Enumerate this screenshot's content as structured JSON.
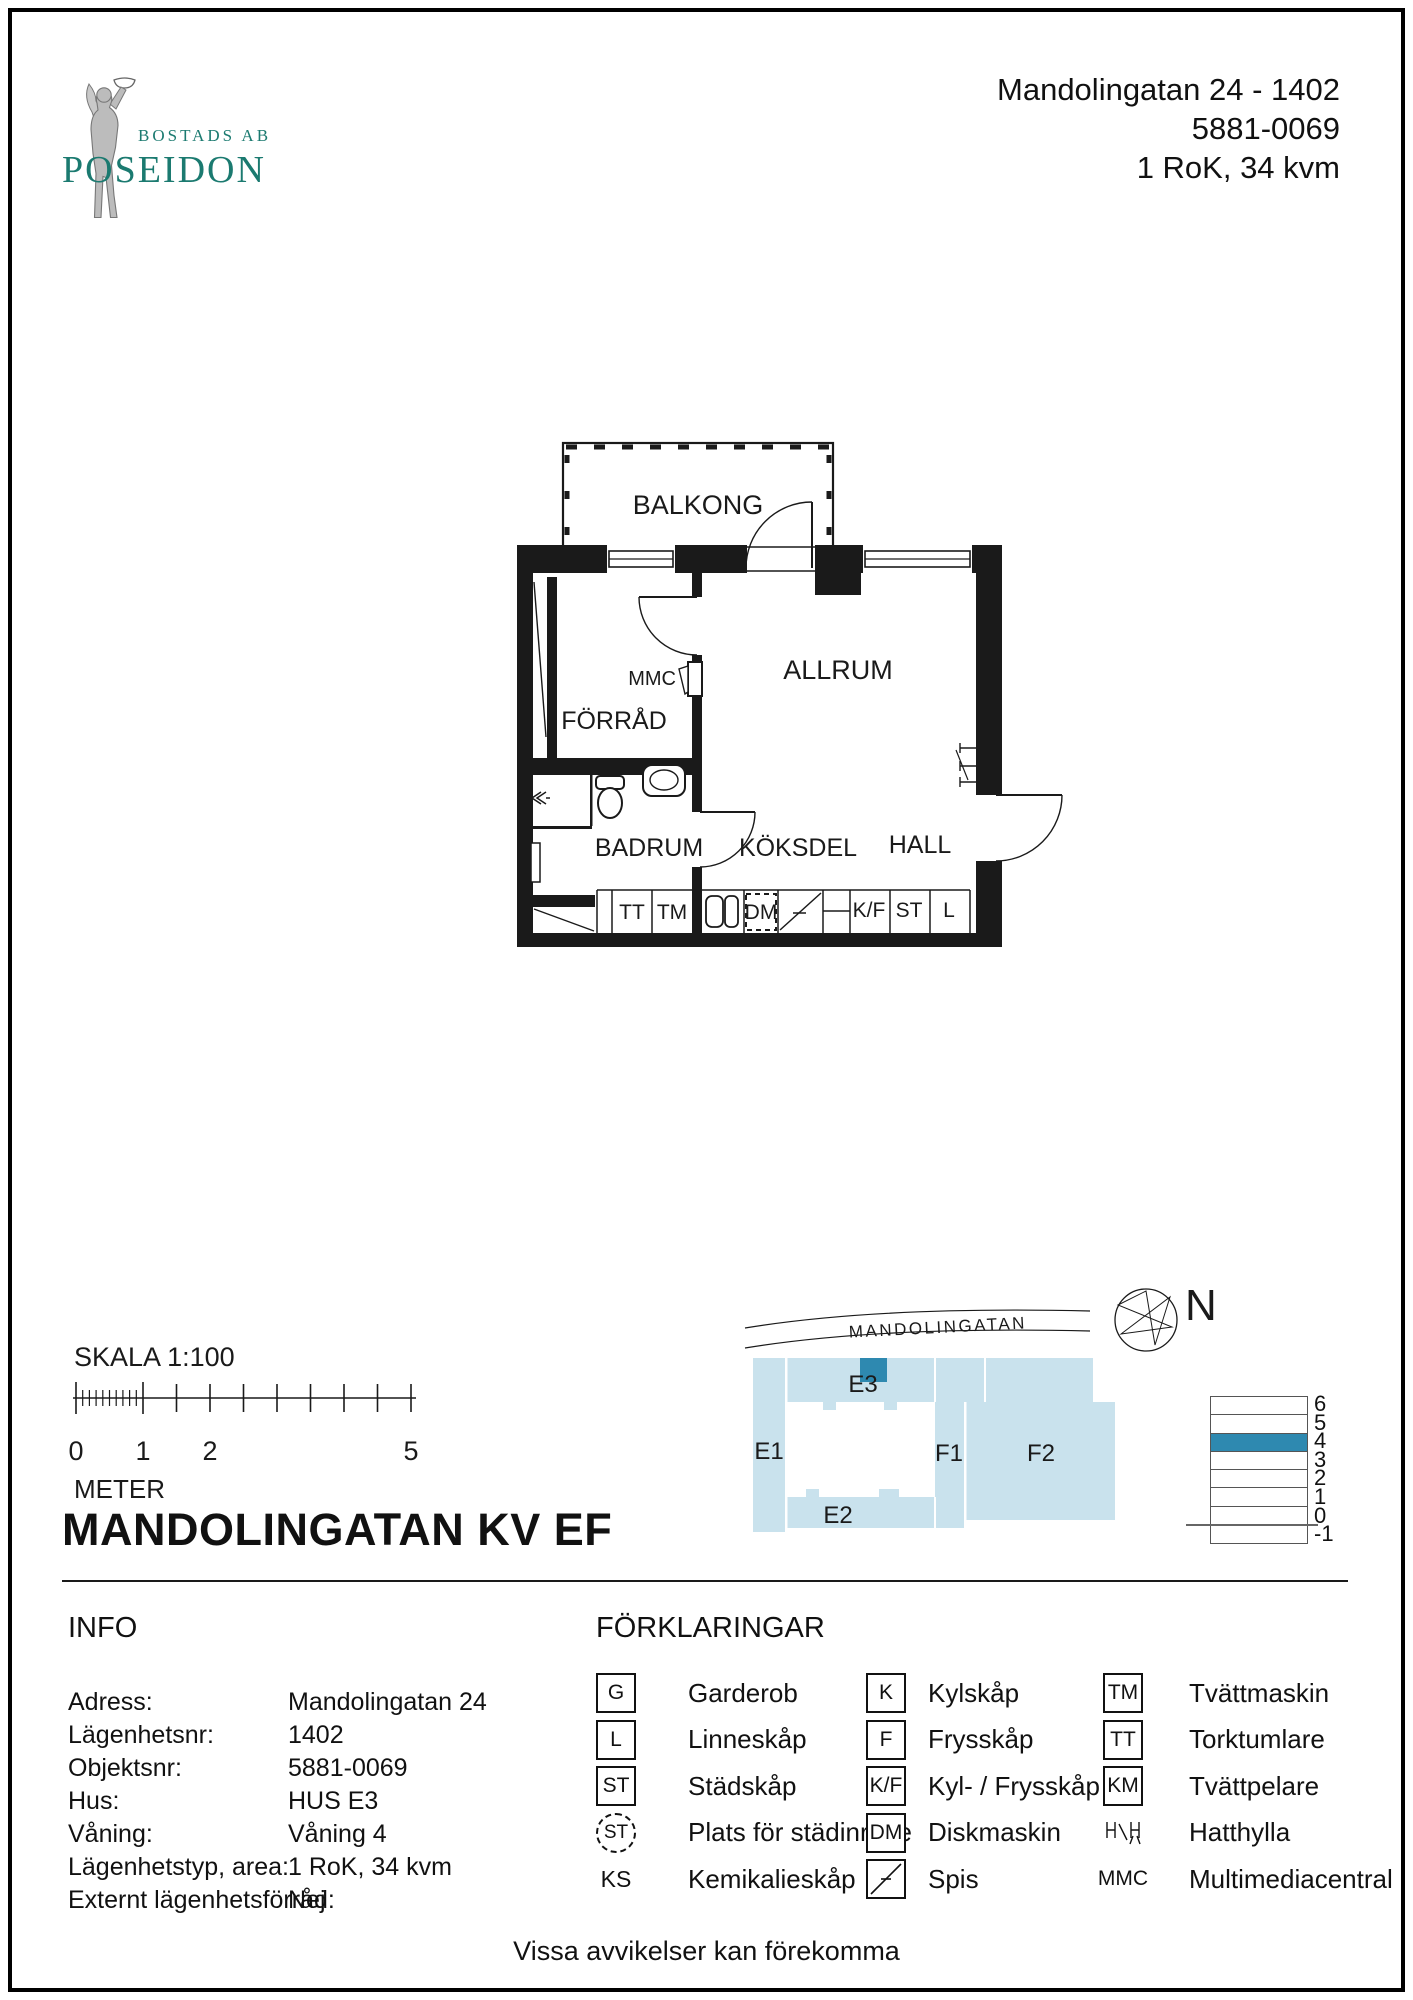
{
  "logo": {
    "company_prefix": "BOSTADS AB",
    "company_name": "POSEIDON"
  },
  "header": {
    "address": "Mandolingatan 24  - 1402",
    "object_number": "5881-0069",
    "apartment_type": "1 RoK, 34 kvm"
  },
  "plan": {
    "balkong": "BALKONG",
    "allrum": "ALLRUM",
    "forrad": "FÖRRÅD",
    "mmc": "MMC",
    "badrum": "BADRUM",
    "koksdel": "KÖKSDEL",
    "hall": "HALL",
    "cells": {
      "tt": "TT",
      "tm": "TM",
      "dm": "DM",
      "kf": "K/F",
      "st": "ST",
      "l": "L"
    }
  },
  "scalebar": {
    "label": "SKALA 1:100",
    "tick0": "0",
    "tick1": "1",
    "tick2": "2",
    "tick5": "5",
    "unit": "METER"
  },
  "title": "MANDOLINGATAN KV EF",
  "site": {
    "street": "MANDOLINGATAN",
    "north": "N",
    "e1": "E1",
    "e2": "E2",
    "e3": "E3",
    "f1": "F1",
    "f2": "F2",
    "building_color": "#c9e2ed",
    "highlight_color": "#2e89b0"
  },
  "floors": {
    "levels": [
      "6",
      "5",
      "4",
      "3",
      "2",
      "1",
      "0",
      "-1"
    ],
    "highlighted_level": "4"
  },
  "info": {
    "heading": "INFO",
    "rows": [
      {
        "label": "Adress:",
        "value": "Mandolingatan 24"
      },
      {
        "label": "Lägenhetsnr:",
        "value": "1402"
      },
      {
        "label": "Objektsnr:",
        "value": "5881-0069"
      },
      {
        "label": "Hus:",
        "value": "HUS E3"
      },
      {
        "label": "Våning:",
        "value": "Våning 4"
      },
      {
        "label": "Lägenhetstyp, area:",
        "value": "1 RoK, 34 kvm"
      },
      {
        "label": "Externt lägenhetsförråd:",
        "value": "Nej"
      }
    ]
  },
  "legend": {
    "heading": "FÖRKLARINGAR",
    "col1": [
      {
        "sym": "G",
        "label": "Garderob"
      },
      {
        "sym": "L",
        "label": "Linneskåp"
      },
      {
        "sym": "ST",
        "label": "Städskåp"
      },
      {
        "sym": "ST",
        "label": "Plats för städinrede"
      },
      {
        "sym": "KS",
        "label": "Kemikalieskåp"
      }
    ],
    "col2": [
      {
        "sym": "K",
        "label": "Kylskåp"
      },
      {
        "sym": "F",
        "label": "Frysskåp"
      },
      {
        "sym": "K/F",
        "label": "Kyl- / Frysskåp"
      },
      {
        "sym": "DM",
        "label": "Diskmaskin"
      },
      {
        "sym": "",
        "label": "Spis"
      }
    ],
    "col3": [
      {
        "sym": "TM",
        "label": "Tvättmaskin"
      },
      {
        "sym": "TT",
        "label": "Torktumlare"
      },
      {
        "sym": "KM",
        "label": "Tvättpelare"
      },
      {
        "sym": "",
        "label": "Hatthylla"
      },
      {
        "sym": "MMC",
        "label": "Multimediacentral"
      }
    ]
  },
  "footer": "Vissa avvikelser kan förekomma"
}
